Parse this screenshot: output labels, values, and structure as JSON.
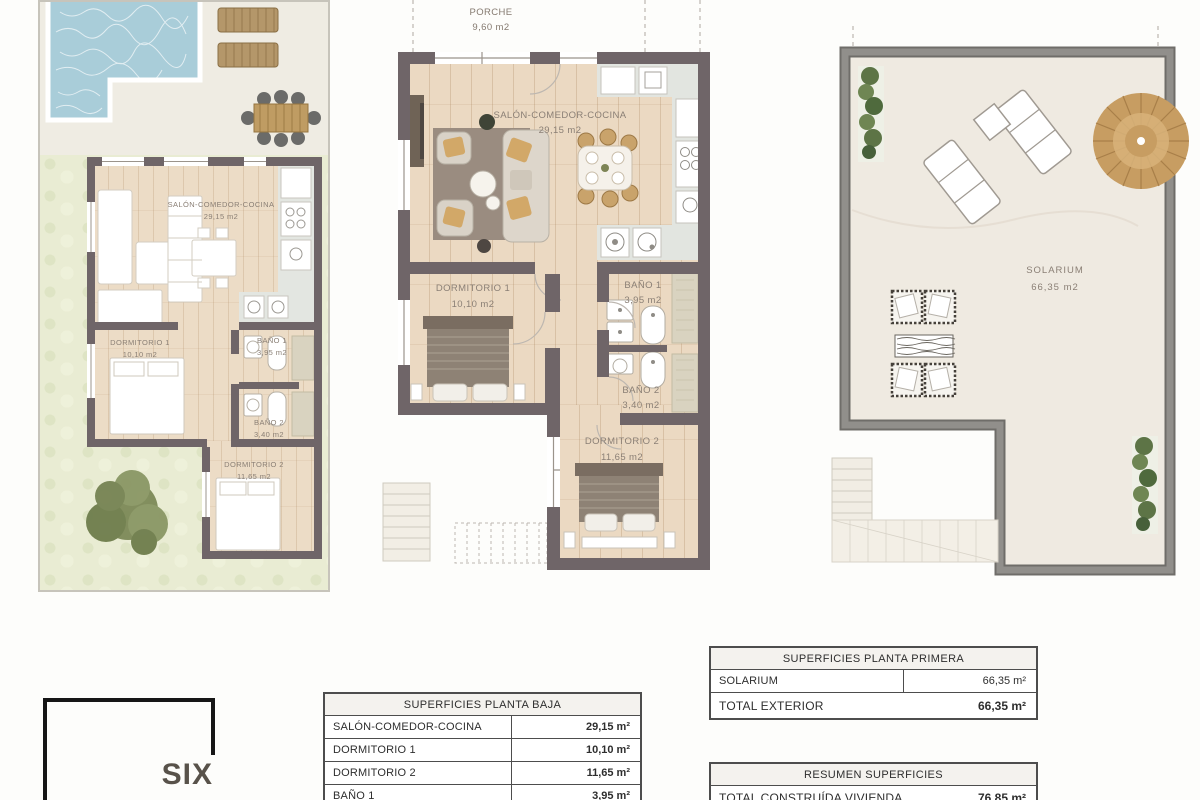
{
  "meta": {
    "type": "architectural-floor-plan-sheet"
  },
  "palette": {
    "wall_dark": "#6f6568",
    "wall_gray": "#8e8c88",
    "wood_floor": "#ecdcc6",
    "kitchen_tile": "#e3e6e1",
    "shower_tile": "#d9d3c0",
    "garden_green": "#e9ecd3",
    "patio_beige": "#efece3",
    "pool_blue": "#a9cdd9",
    "rug_brown": "#9a8c80",
    "cushion_mustard": "#d2a868",
    "label_text": "#8a7f75",
    "table_text": "#2e2e2e",
    "logo_text": "#58524a",
    "rattan": "#c79d62",
    "plant_green": "#64794b",
    "lounger_wood": "#b4976a",
    "solarium_floor": "#efeae1"
  },
  "plan_ground_garden": {
    "rooms": [
      {
        "name": "SALÓN-COMEDOR-COCINA",
        "area": "29,15 m2"
      },
      {
        "name": "DORMITORIO 1",
        "area": "10,10 m2"
      },
      {
        "name": "BAÑO 1",
        "area": "3,95 m2"
      },
      {
        "name": "BAÑO 2",
        "area": "3,40 m2"
      },
      {
        "name": "DORMITORIO 2",
        "area": "11,65 m2"
      }
    ]
  },
  "plan_ground_detail": {
    "porch": {
      "name": "PORCHE",
      "area": "9,60 m2"
    },
    "rooms": [
      {
        "name": "SALÓN-COMEDOR-COCINA",
        "area": "29,15 m2"
      },
      {
        "name": "DORMITORIO 1",
        "area": "10,10 m2"
      },
      {
        "name": "BAÑO 1",
        "area": "3,95 m2"
      },
      {
        "name": "BAÑO 2",
        "area": "3,40 m2"
      },
      {
        "name": "DORMITORIO 2",
        "area": "11,65 m2"
      }
    ]
  },
  "plan_first": {
    "rooms": [
      {
        "name": "SOLARIUM",
        "area": "66,35 m2"
      }
    ]
  },
  "tables": {
    "planta_baja": {
      "title": "SUPERFICIES PLANTA BAJA",
      "rows": [
        {
          "label": "SALÓN-COMEDOR-COCINA",
          "value": "29,15 m²"
        },
        {
          "label": "DORMITORIO 1",
          "value": "10,10 m²"
        },
        {
          "label": "DORMITORIO 2",
          "value": "11,65 m²"
        },
        {
          "label": "BAÑO 1",
          "value": "3,95 m²"
        }
      ]
    },
    "planta_primera": {
      "title": "SUPERFICIES PLANTA PRIMERA",
      "rows": [
        {
          "label": "SOLARIUM",
          "value": "66,35 m²"
        },
        {
          "label": "TOTAL EXTERIOR",
          "value": "66,35 m²"
        }
      ]
    },
    "resumen": {
      "title": "RESUMEN SUPERFICIES",
      "rows": [
        {
          "label": "TOTAL CONSTRUÍDA VIVIENDA",
          "value": "76,85 m²"
        }
      ]
    }
  },
  "logo": {
    "line1": "SIX",
    "line2": "SEGURA"
  }
}
